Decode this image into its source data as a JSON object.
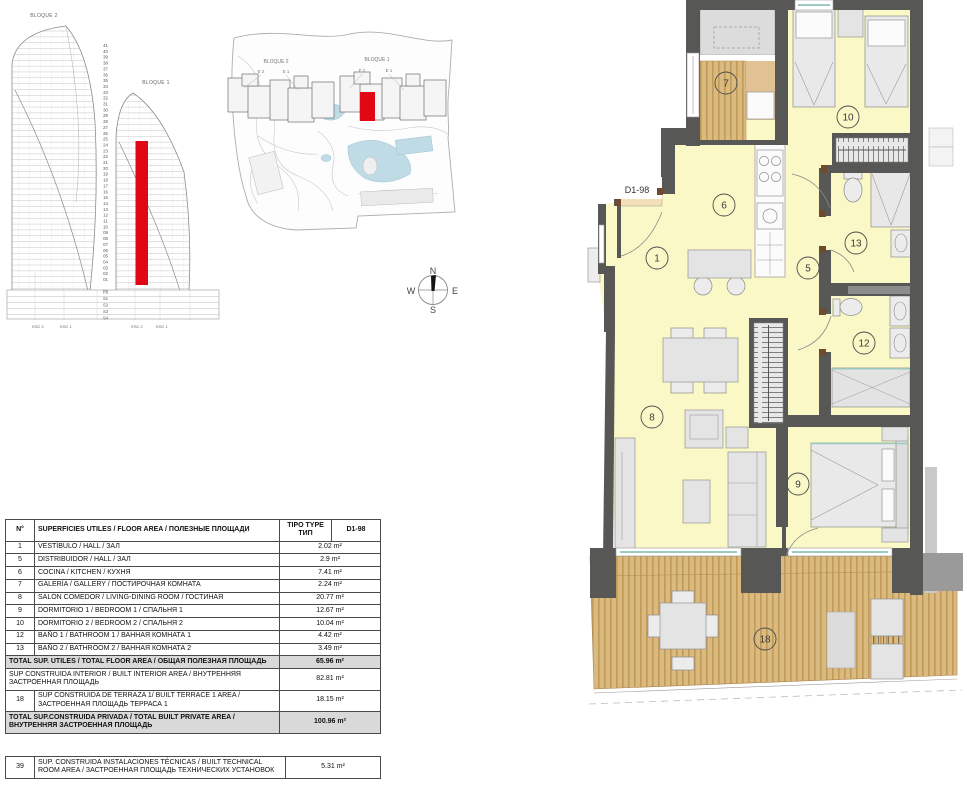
{
  "unit": "D1-98",
  "elevation": {
    "bloque2_label": "BLOQUE 2",
    "bloque1_label": "BLOQUE 1",
    "floors": [
      "41",
      "40",
      "39",
      "38",
      "37",
      "36",
      "35",
      "34",
      "33",
      "32",
      "31",
      "30",
      "29",
      "28",
      "27",
      "26",
      "25",
      "24",
      "23",
      "22",
      "21",
      "20",
      "19",
      "18",
      "17",
      "16",
      "15",
      "14",
      "13",
      "12",
      "11",
      "10",
      "09",
      "08",
      "07",
      "06",
      "05",
      "04",
      "03",
      "02",
      "01"
    ],
    "basement_levels": [
      "PB",
      "S1",
      "S2",
      "S3",
      "S4"
    ],
    "stair_labels": [
      "ESC 2",
      "ESC 1",
      "ESC 2",
      "ESC 1"
    ]
  },
  "site_plan": {
    "bloque2_label": "BLOQUE 2",
    "bloque1_label": "BLOQUE 1",
    "entrance_labels": [
      "E 2",
      "E 1",
      "E 2",
      "E 1"
    ]
  },
  "compass": {
    "n": "N",
    "s": "S",
    "e": "E",
    "w": "W"
  },
  "floor_plan": {
    "unit_label": "D1-98",
    "room_numbers": [
      "1",
      "5",
      "6",
      "7",
      "8",
      "9",
      "10",
      "12",
      "13",
      "18"
    ]
  },
  "colors": {
    "highlight_red": "#E30613",
    "wall_gray": "#575756",
    "floor_yellow": "#FAF8C6",
    "wood_tan": "#D9BA80",
    "total_row_gray": "#D9D9D9",
    "pool_blue": "#BFDBE5",
    "window_teal": "#9CC9C1"
  },
  "area_table": {
    "header": {
      "num": "N°",
      "title": "SUPERFICIES UTILES / FLOOR AREA / ПОЛЕЗНЫЕ ПЛОЩАДИ",
      "type_line1": "TIPO TYPE",
      "type_line2": "ТИП",
      "unit": "D1-98"
    },
    "rows": [
      {
        "num": "1",
        "desc": "VESTÍBULO / HALL / ЗАЛ",
        "value": "2.02 m²",
        "style": "normal"
      },
      {
        "num": "5",
        "desc": "DISTRIBUIDOR /  HALL / ЗАЛ",
        "value": "2.9 m²",
        "style": "normal"
      },
      {
        "num": "6",
        "desc": "COCINA / KITCHEN / КУХНЯ",
        "value": "7.41 m²",
        "style": "normal"
      },
      {
        "num": "7",
        "desc": "GALERÍA / GALLERY / ПОСТИРОЧНАЯ КОМНАТА",
        "value": "2.24 m²",
        "style": "normal"
      },
      {
        "num": "8",
        "desc": "SALÓN COMEDOR  / LIVING-DINING ROOM / ГОСТИНАЯ",
        "value": "20.77 m²",
        "style": "normal"
      },
      {
        "num": "9",
        "desc": "DORMITORIO 1 / BEDROOM 1 / СПАЛЬНЯ 1",
        "value": "12.67 m²",
        "style": "normal"
      },
      {
        "num": "10",
        "desc": "DORMITORIO 2 / BEDROOM 2 / СПАЛЬНЯ 2",
        "value": "10.04 m²",
        "style": "normal"
      },
      {
        "num": "12",
        "desc": "BAÑO 1 / BATHROOM 1 / ВАННАЯ КОМНАТА 1",
        "value": "4.42 m²",
        "style": "normal"
      },
      {
        "num": "13",
        "desc": "BAÑO 2 / BATHROOM 2 / ВАННАЯ КОМНАТА 2",
        "value": "3.49 m²",
        "style": "normal"
      },
      {
        "num": null,
        "desc": "TOTAL SUP. UTILES / TOTAL FLOOR AREA / ОБЩАЯ ПОЛЕЗНАЯ ПЛОЩАДЬ",
        "value": "65.96 m²",
        "style": "total"
      },
      {
        "num": null,
        "desc": "SUP CONSTRUIDA INTERIOR / BUILT INTERIOR AREA / ВНУТРЕННЯЯ ЗАСТРОЕННАЯ  ПЛОЩАДЬ",
        "value": "82.81 m²",
        "style": "merged"
      },
      {
        "num": "18",
        "desc": "SUP CONSTRUIDA  DE TERRAZA 1/ BUILT TERRACE 1 AREA / ЗАСТРОЕННАЯ ПЛОЩАДЬ ТЕРРАСА 1",
        "value": "18.15 m²",
        "style": "normal"
      },
      {
        "num": null,
        "desc": "TOTAL SUP.CONSTRUIDA PRIVADA / TOTAL  BUILT PRIVATE AREA / ВНУТРЕННЯЯ ЗАСТРОЕННАЯ ПЛОЩАДЬ",
        "value": "100.96 m²",
        "style": "total"
      }
    ]
  },
  "tech_table": {
    "num": "39",
    "desc": "SUP. CONSTRUIDA INSTALACIONES TÉCNICAS / BUILT TECHNICAL ROOM AREA / ЗАСТРОЕННАЯ ПЛОЩАДЬ ТЕХНИЧЕСКИХ УСТАНОВОК",
    "value": "5.31 m²"
  }
}
